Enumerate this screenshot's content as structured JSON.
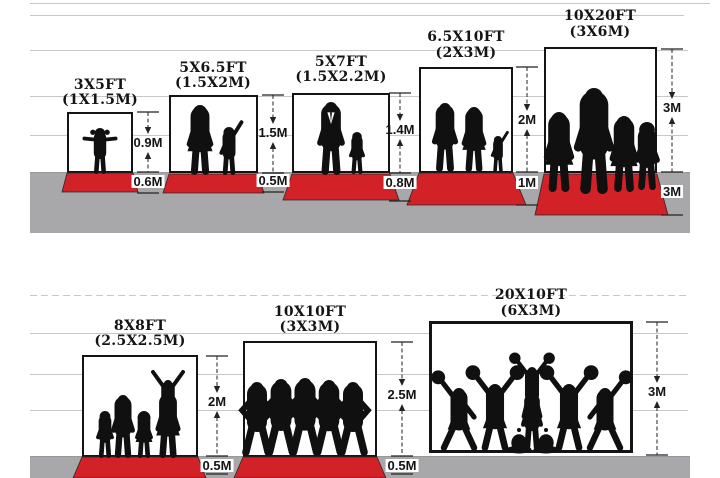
{
  "top": {
    "panels": [
      {
        "id": "3x5",
        "title": "3X5FT",
        "subtitle": "(1X1.5M)",
        "height_label": "0.9M",
        "floor_label": "0.6M",
        "figures": [
          "toddler-girl"
        ]
      },
      {
        "id": "5x6.5",
        "title": "5X6.5FT",
        "subtitle": "(1.5X2M)",
        "height_label": "1.5M",
        "floor_label": "0.5M",
        "figures": [
          "woman",
          "child-waving"
        ]
      },
      {
        "id": "5x7",
        "title": "5X7FT",
        "subtitle": "(1.5X2.2M)",
        "height_label": "1.4M",
        "floor_label": "0.8M",
        "figures": [
          "man-in-suit",
          "boy"
        ]
      },
      {
        "id": "6.5x10",
        "title": "6.5X10FT",
        "subtitle": "(2X3M)",
        "height_label": "2M",
        "floor_label": "1M",
        "figures": [
          "man",
          "woman",
          "child-waving"
        ]
      },
      {
        "id": "10x20",
        "title": "10X20FT",
        "subtitle": "(3X6M)",
        "height_label": "3M",
        "floor_label": "3M",
        "figures": [
          "woman",
          "man",
          "woman",
          "boy"
        ]
      }
    ]
  },
  "bottom": {
    "panels": [
      {
        "id": "8x8",
        "title": "8X8FT",
        "subtitle": "(2.5X2.5M)",
        "height_label": "2M",
        "floor_label": "0.5M",
        "figures": [
          "boy",
          "man",
          "girl",
          "woman",
          "child-on-shoulders"
        ]
      },
      {
        "id": "10x10",
        "title": "10X10FT",
        "subtitle": "(3X3M)",
        "height_label": "2.5M",
        "floor_label": "0.5M",
        "figures": [
          "man",
          "man",
          "man",
          "man",
          "man"
        ]
      },
      {
        "id": "20x10",
        "title": "20X10FT",
        "subtitle": "(6X3M)",
        "height_label": "3M",
        "floor_label": null,
        "figures": [
          "cheerleader-left",
          "cheerleader",
          "cheerleader-top",
          "cheerleader-base",
          "sitting-cheerleader",
          "sitting-cheerleader",
          "cheerleader",
          "cheerleader-right"
        ]
      }
    ]
  },
  "colors": {
    "carpet_red": "#d22127",
    "floor_gray": "#a8a8aa",
    "silhouette": "#101010",
    "wall_line": "#c7c7c9",
    "frame_border": "#141414",
    "text": "#141414"
  }
}
